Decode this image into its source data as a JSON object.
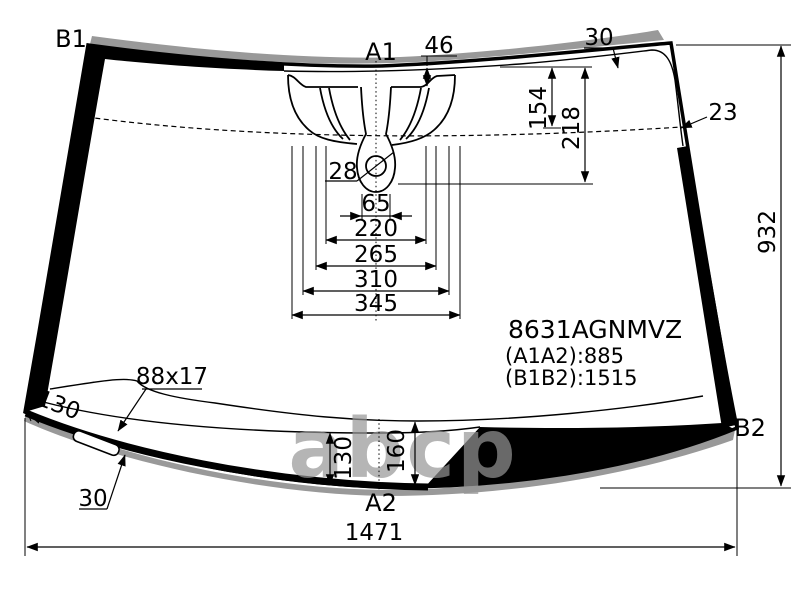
{
  "title_block": {
    "part_code": "8631AGNMVZ",
    "a1a2": "(A1A2):885",
    "b1b2": "(B1B2):1515"
  },
  "corner_labels": {
    "b1": "B1",
    "a1": "A1",
    "a2": "A2",
    "b2": "B2"
  },
  "dimensions": {
    "offset_top": "46",
    "band_top_right": "30",
    "band_right": "23",
    "hole_diameter": "28",
    "bracket_w1": "65",
    "bracket_w2": "220",
    "bracket_w3": "265",
    "bracket_w4": "310",
    "bracket_w5": "345",
    "band_depth": "154",
    "sensor_depth": "218",
    "height_right": "932",
    "width_bottom": "1471",
    "edge_bottom_left": "130",
    "sticker_size": "88x17",
    "sticker_offset": "30",
    "band_bottom_inner": "130",
    "band_bottom_outer": "160"
  },
  "watermark": "abcp",
  "colors": {
    "line": "#000000",
    "background": "#ffffff",
    "molding": "#999999",
    "ceramic_band": "#000000",
    "watermark": "#a8a8a8"
  }
}
